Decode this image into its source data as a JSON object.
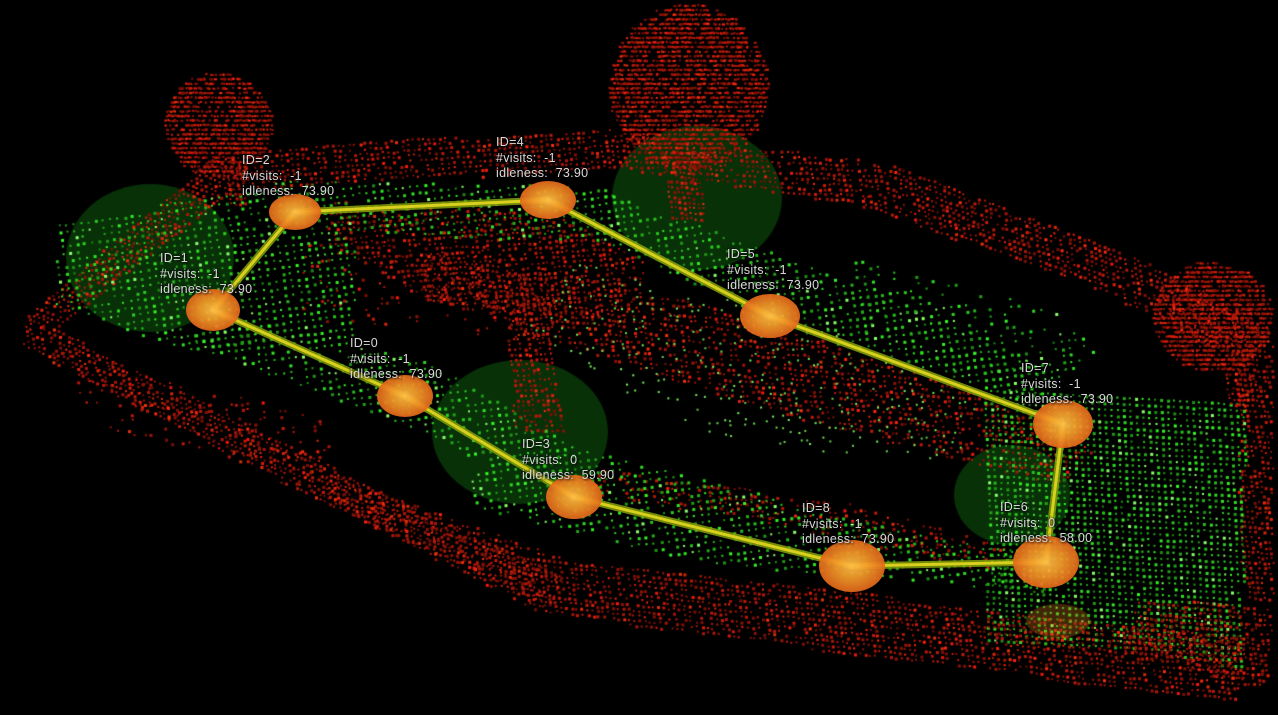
{
  "app": {
    "name": "3D point-cloud patrol view",
    "background": "#000000"
  },
  "scene": {
    "ground_point_color": "#2fb622",
    "ground_point_bright": "#8cff6e",
    "obstacle_point_color": "#c41708",
    "obstacle_point_bright": "#f1351a",
    "range_circle_fill": "rgba(16,98,16,0.5)",
    "ghost_marker": {
      "cx": 1058,
      "cy": 621,
      "rx": 32,
      "ry": 17,
      "fill": "rgba(235,140,30,0.28)"
    }
  },
  "graph": {
    "edge_glow_color": "#84a00a",
    "edge_core_color": "#ddd41f",
    "node_center_color": "#ffbe46",
    "node_mid_color": "#f39c2a",
    "node_edge_color": "#e2661a",
    "nodes": [
      {
        "id": "0",
        "x": 405,
        "y": 396,
        "rx": 28,
        "ry": 21,
        "label_x": 350,
        "label_y": 336,
        "lines": {
          "id": "ID=0",
          "visits": "#visits:  -1",
          "idleness": "idleness:  73.90"
        }
      },
      {
        "id": "1",
        "x": 213,
        "y": 310,
        "rx": 27,
        "ry": 21,
        "label_x": 160,
        "label_y": 251,
        "lines": {
          "id": "ID=1",
          "visits": "#visits:  -1",
          "idleness": "idleness:  73.90"
        }
      },
      {
        "id": "2",
        "x": 295,
        "y": 212,
        "rx": 26,
        "ry": 18,
        "label_x": 242,
        "label_y": 153,
        "lines": {
          "id": "ID=2",
          "visits": "#visits:  -1",
          "idleness": "idleness:  73.90"
        }
      },
      {
        "id": "3",
        "x": 574,
        "y": 497,
        "rx": 28,
        "ry": 22,
        "label_x": 522,
        "label_y": 437,
        "lines": {
          "id": "ID=3",
          "visits": "#visits:  0",
          "idleness": "idleness:  59.90"
        }
      },
      {
        "id": "4",
        "x": 548,
        "y": 200,
        "rx": 28,
        "ry": 19,
        "label_x": 496,
        "label_y": 135,
        "lines": {
          "id": "ID=4",
          "visits": "#visits:  -1",
          "idleness": "idleness:  73.90"
        }
      },
      {
        "id": "5",
        "x": 770,
        "y": 316,
        "rx": 30,
        "ry": 22,
        "label_x": 727,
        "label_y": 247,
        "lines": {
          "id": "ID=5",
          "visits": "#visits:  -1",
          "idleness": "idleness:  73.90"
        }
      },
      {
        "id": "6",
        "x": 1046,
        "y": 562,
        "rx": 33,
        "ry": 26,
        "label_x": 1000,
        "label_y": 500,
        "lines": {
          "id": "ID=6",
          "visits": "#visits:  0",
          "idleness": "idleness:  58.00"
        }
      },
      {
        "id": "7",
        "x": 1063,
        "y": 424,
        "rx": 30,
        "ry": 24,
        "label_x": 1021,
        "label_y": 361,
        "lines": {
          "id": "ID=7",
          "visits": "#visits:  -1",
          "idleness": "idleness:  73.90"
        }
      },
      {
        "id": "8",
        "x": 852,
        "y": 566,
        "rx": 33,
        "ry": 26,
        "label_x": 802,
        "label_y": 501,
        "lines": {
          "id": "ID=8",
          "visits": "#visits:  -1",
          "idleness": "idleness:  73.90"
        }
      }
    ],
    "edges": [
      [
        "1",
        "2"
      ],
      [
        "2",
        "4"
      ],
      [
        "4",
        "5"
      ],
      [
        "5",
        "7"
      ],
      [
        "7",
        "6"
      ],
      [
        "6",
        "8"
      ],
      [
        "8",
        "3"
      ],
      [
        "3",
        "0"
      ],
      [
        "0",
        "1"
      ]
    ],
    "range_circles": [
      {
        "cx": 150,
        "cy": 258,
        "rx": 84,
        "ry": 74
      },
      {
        "cx": 697,
        "cy": 198,
        "rx": 85,
        "ry": 72
      },
      {
        "cx": 520,
        "cy": 432,
        "rx": 88,
        "ry": 72
      },
      {
        "cx": 1012,
        "cy": 495,
        "rx": 58,
        "ry": 50
      }
    ]
  }
}
